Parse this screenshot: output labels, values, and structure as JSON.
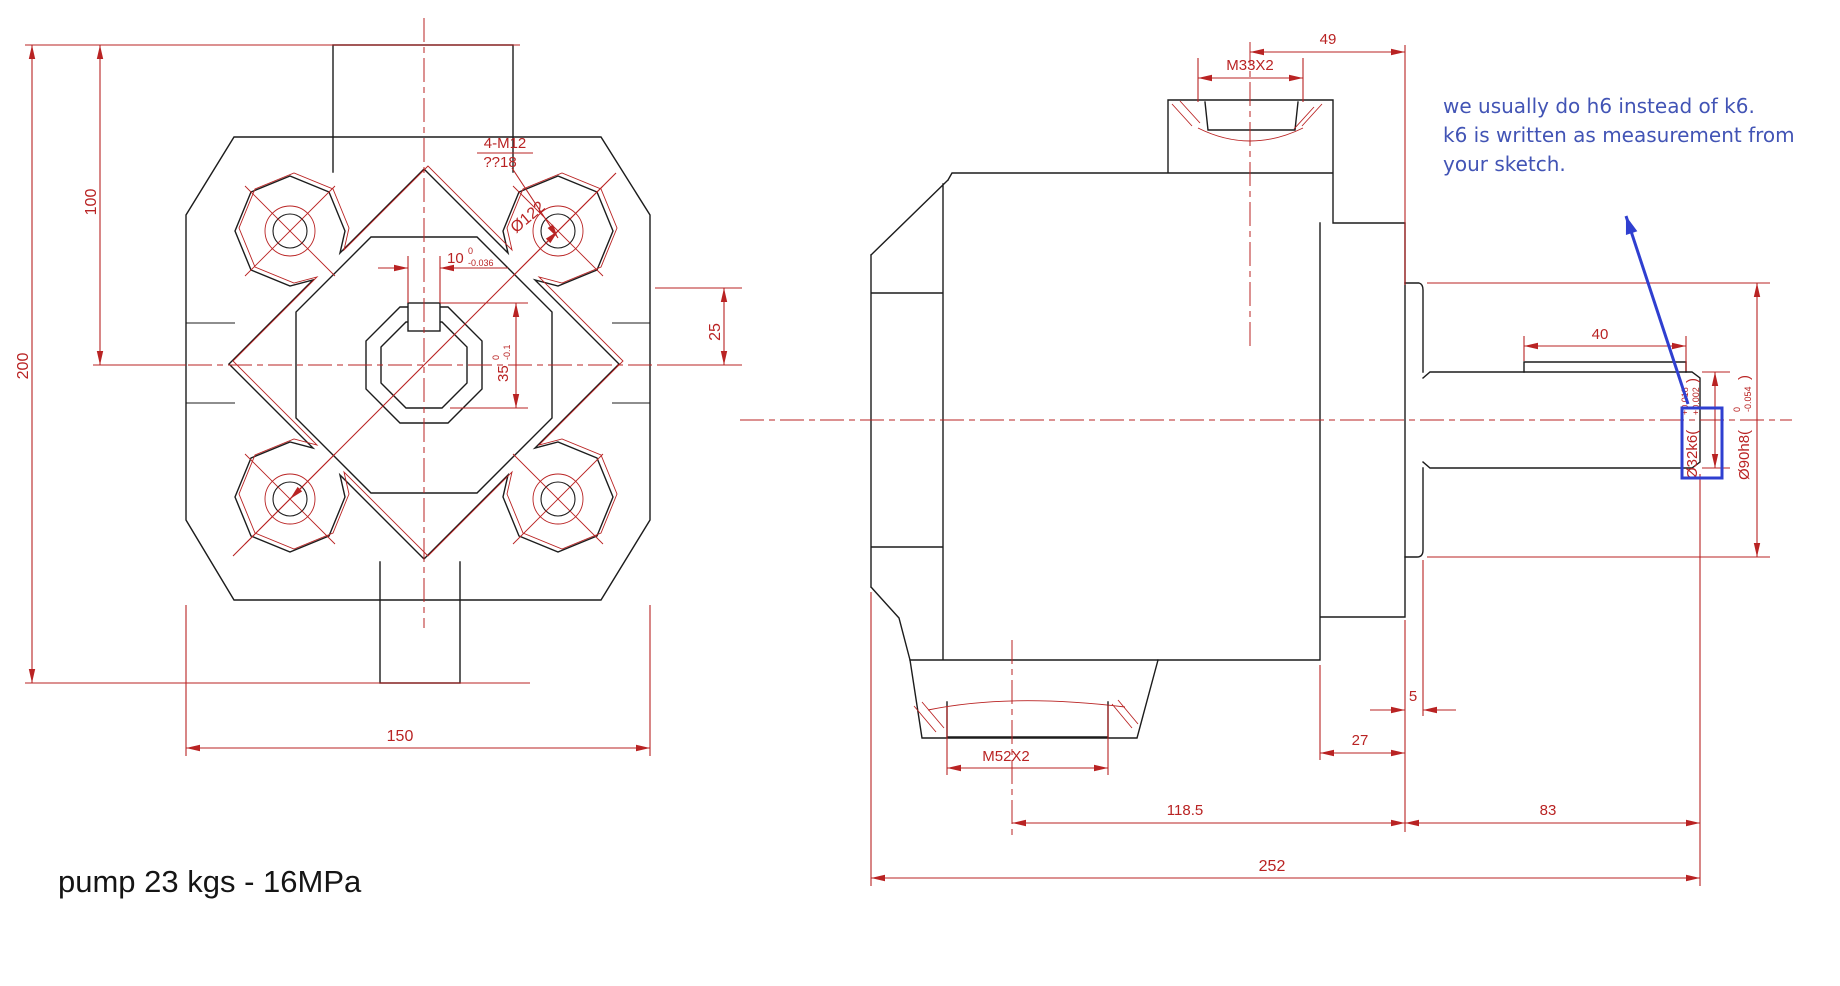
{
  "footer": {
    "text": "pump 23 kgs - 16MPa"
  },
  "note": {
    "lines": [
      "we usually do h6 instead of k6.",
      "k6 is written as measurement from",
      "your sketch."
    ],
    "color": "#4254b5"
  },
  "colors": {
    "outline": "#1c1c1c",
    "dimension_red": "#b92323",
    "annotation_blue": "#2f3fd0",
    "background": "#ffffff"
  },
  "front_view": {
    "dim_total_height": "200",
    "dim_upper_height": "100",
    "dim_width": "150",
    "dim_offset": "25",
    "dim_bolt_circle": "Ø122",
    "bolt_callout": "4-M12",
    "bolt_depth": "??18",
    "keyway_width": {
      "nominal": "10",
      "upper": "0",
      "lower": "-0.036"
    },
    "bore_height": {
      "nominal": "35",
      "upper": "0",
      "lower": "-0.1"
    }
  },
  "side_view": {
    "dim_port_offset": "49",
    "thread_top": "M33X2",
    "dim_key_length": "40",
    "dim_spigot_width": "5",
    "dim_flange_width": "27",
    "thread_bottom": "M52X2",
    "dim_body_length": "118.5",
    "dim_shaft_section": "83",
    "dim_total_length": "252",
    "shaft_dia": {
      "nominal": "Ø32k6(",
      "upper": "+0.018",
      "lower": "+0.002",
      "close": ")"
    },
    "spigot_dia": {
      "nominal": "Ø90h8(",
      "upper": "0",
      "lower": "-0.054",
      "close": ")"
    }
  }
}
